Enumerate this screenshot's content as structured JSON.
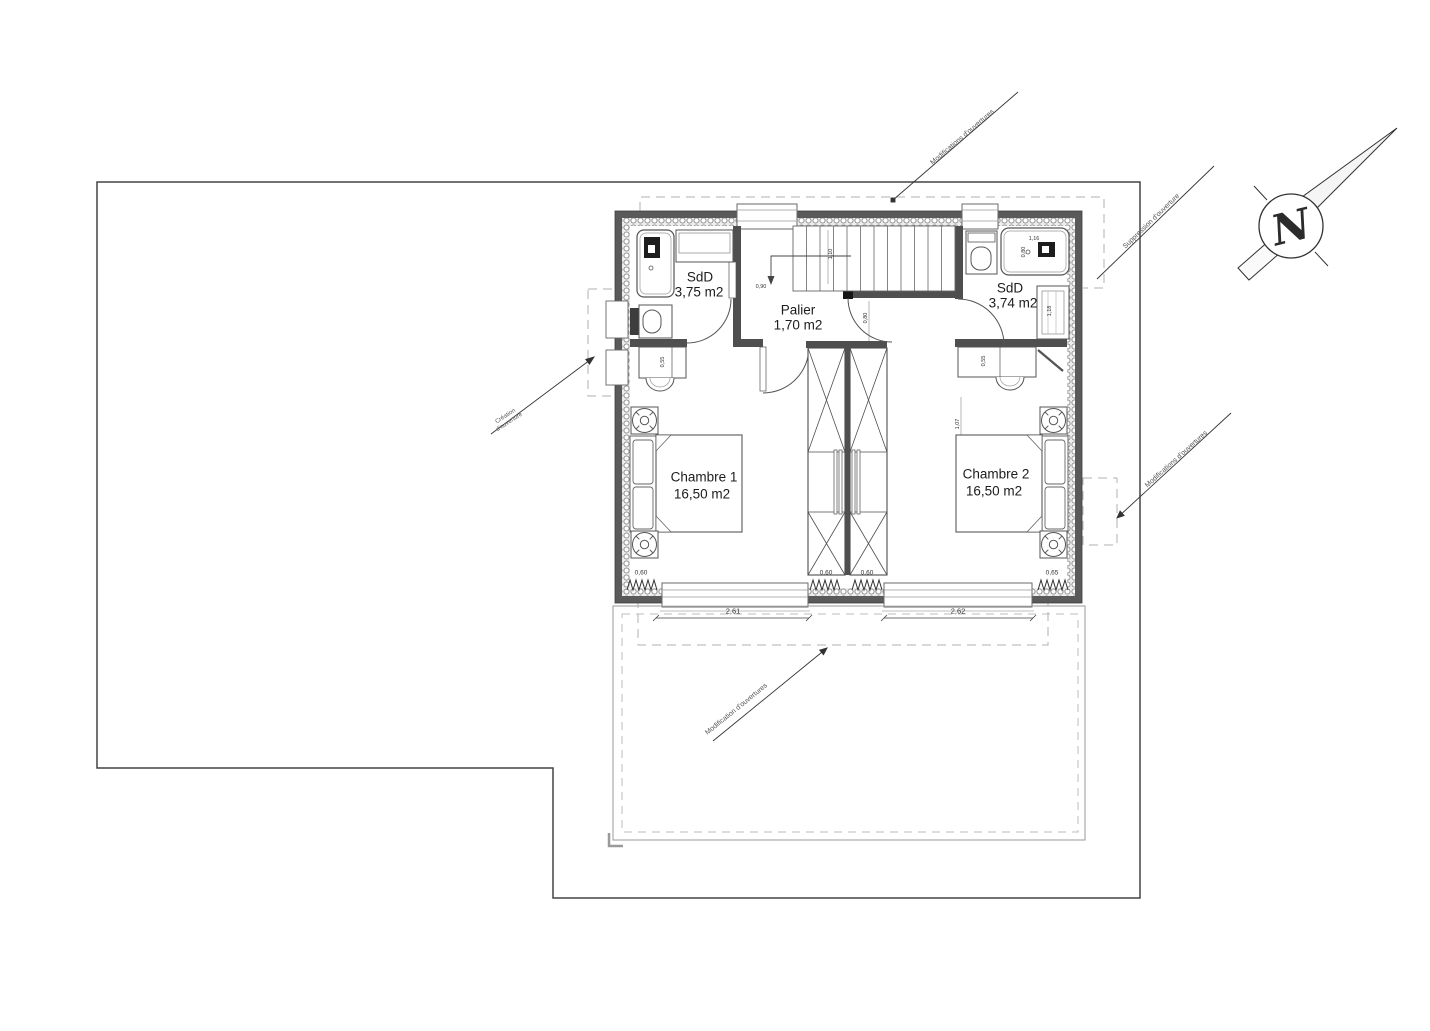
{
  "compass": {
    "label": "N"
  },
  "rooms": {
    "sdd1": {
      "name": "SdD",
      "area": "3,75 m2"
    },
    "palier": {
      "name": "Palier",
      "area": "1,70 m2"
    },
    "sdd2": {
      "name": "SdD",
      "area": "3,74 m2"
    },
    "chambre1": {
      "name": "Chambre 1",
      "area": "16,50 m2"
    },
    "chambre2": {
      "name": "Chambre 2",
      "area": "16,50 m2"
    }
  },
  "annotations": {
    "top": "Modifications d'ouvertures",
    "top_right": "Suppression d'ouverture",
    "left_line1": "Création",
    "left_line2": "d'ouverture",
    "right_middle": "Modifications d'ouvertures",
    "bottom": "Modification d'ouvertures"
  },
  "dimensions": {
    "window_left": "2,61",
    "window_right": "2,62",
    "radiator_left": "0,60",
    "radiator_center_left": "0,60",
    "radiator_center_right": "0,60",
    "radiator_right": "0,65",
    "stair_width": "0,90",
    "stair_run": "1,10",
    "door_palier": "0,80",
    "desk1": "0,55",
    "desk2": "0,55",
    "bed2_offset": "1,07",
    "shower_width": "1,16",
    "shower_depth": "0,80",
    "towel_rail": "1,18"
  },
  "colors": {
    "wall": "#5a5a5a",
    "line": "#333333",
    "dash": "#b0b0b0",
    "paper": "#ffffff"
  }
}
